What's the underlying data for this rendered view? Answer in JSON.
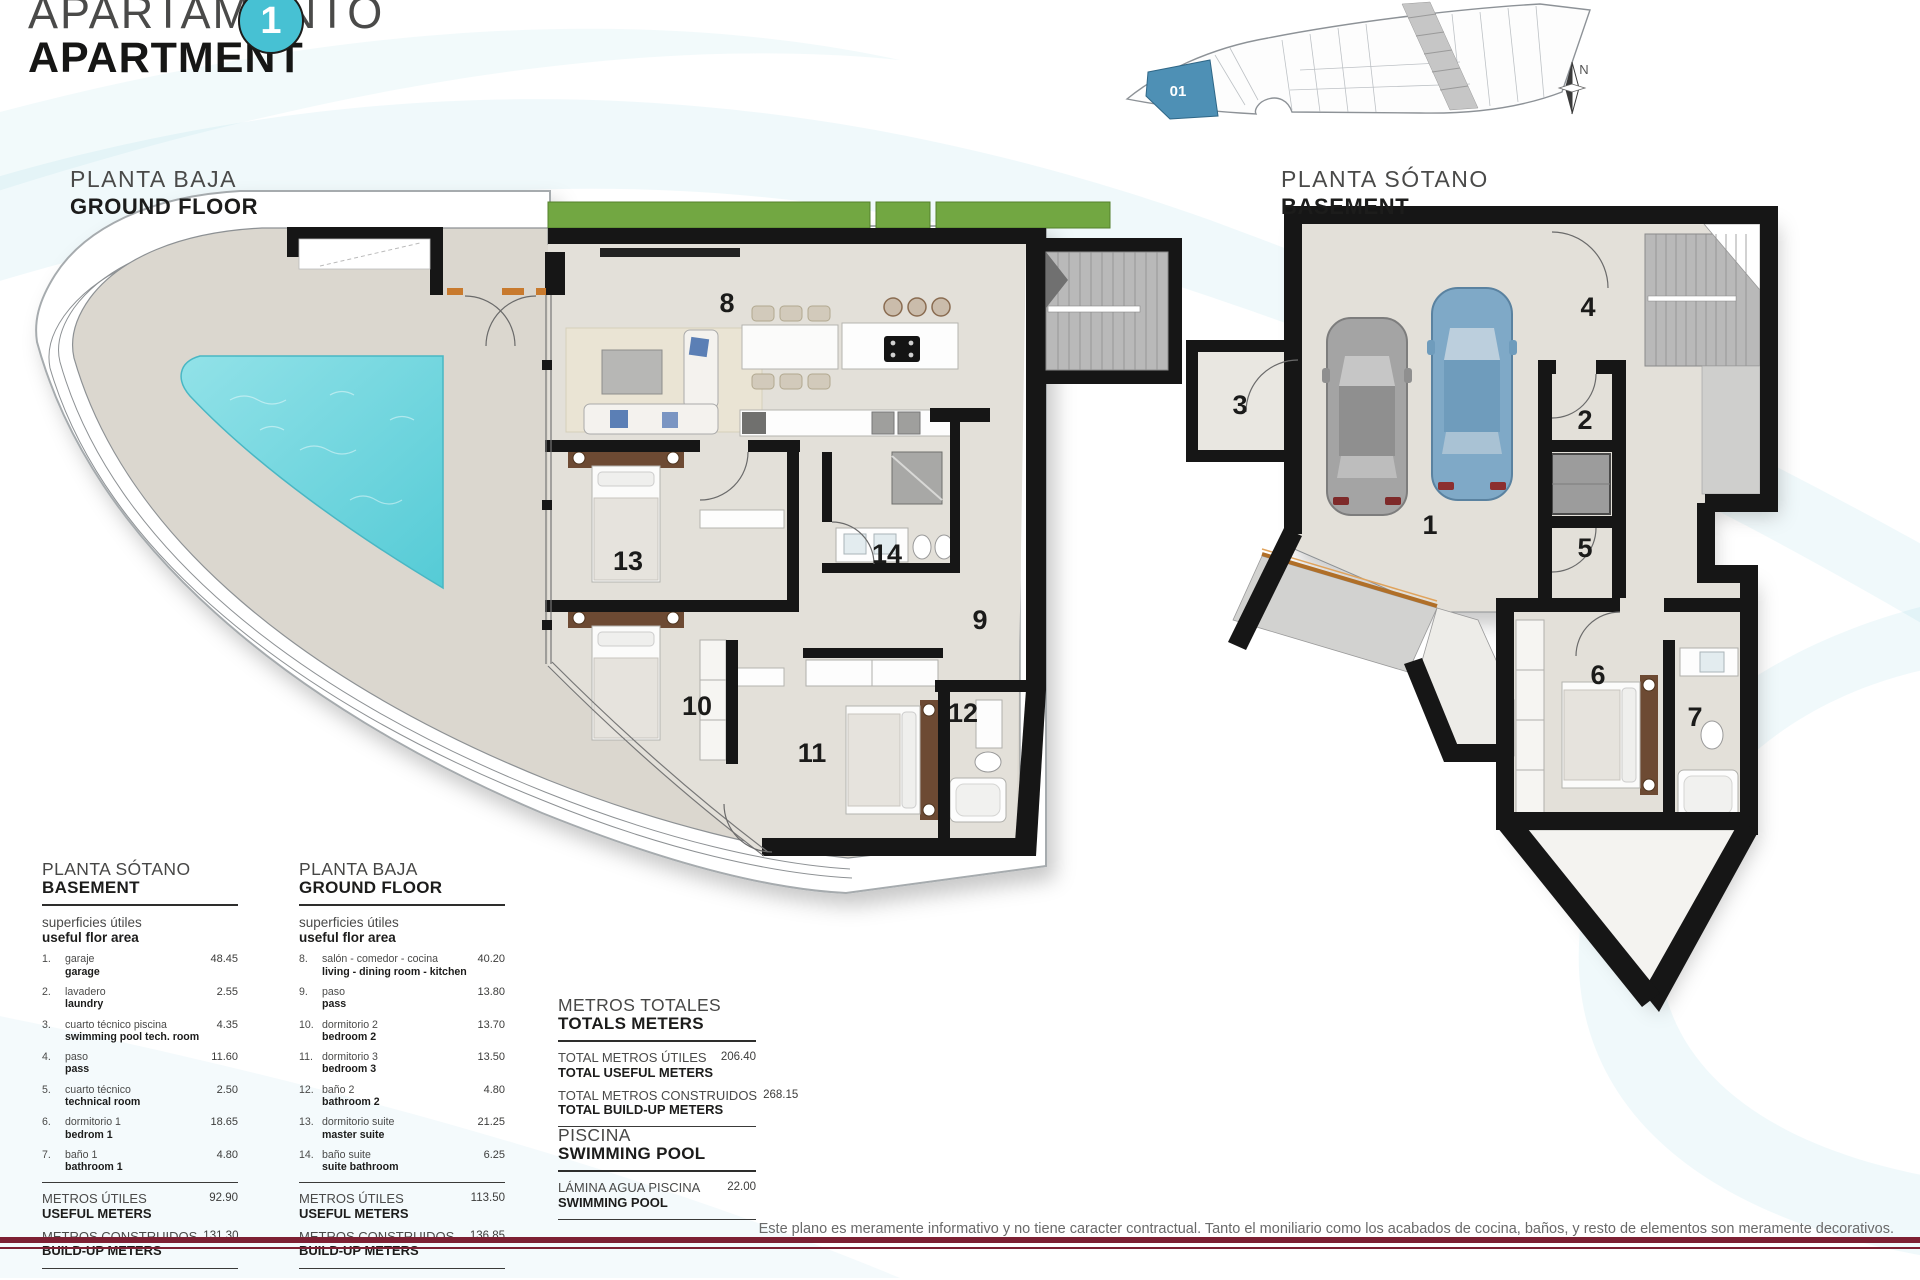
{
  "header": {
    "title_es": "APARTAMENTO",
    "title_en": "APARTMENT",
    "unit_number": "1"
  },
  "site_plan": {
    "unit_label": "01",
    "compass_label": "N"
  },
  "plans": {
    "ground_floor": {
      "label_es": "PLANTA BAJA",
      "label_en": "GROUND FLOOR",
      "rooms": [
        "8",
        "13",
        "14",
        "9",
        "10",
        "11",
        "12"
      ]
    },
    "basement": {
      "label_es": "PLANTA SÓTANO",
      "label_en": "BASEMENT",
      "rooms": [
        "1",
        "2",
        "3",
        "4",
        "5",
        "6",
        "7"
      ]
    }
  },
  "tables": {
    "basement": {
      "title_es": "PLANTA SÓTANO",
      "title_en": "BASEMENT",
      "subtitle_es": "superficies útiles",
      "subtitle_en": "useful flor area",
      "rows": [
        {
          "num": "1.",
          "es": "garaje",
          "en": "garage",
          "value": "48.45"
        },
        {
          "num": "2.",
          "es": "lavadero",
          "en": "laundry",
          "value": "2.55"
        },
        {
          "num": "3.",
          "es": "cuarto técnico piscina",
          "en": "swimming pool tech. room",
          "value": "4.35"
        },
        {
          "num": "4.",
          "es": "paso",
          "en": "pass",
          "value": "11.60"
        },
        {
          "num": "5.",
          "es": "cuarto técnico",
          "en": "technical room",
          "value": "2.50"
        },
        {
          "num": "6.",
          "es": "dormitorio 1",
          "en": "bedrom 1",
          "value": "18.65"
        },
        {
          "num": "7.",
          "es": "baño 1",
          "en": "bathroom 1",
          "value": "4.80"
        }
      ],
      "totals": [
        {
          "es": "METROS ÚTILES",
          "en": "USEFUL METERS",
          "value": "92.90"
        },
        {
          "es": "METROS CONSTRUIDOS",
          "en": "BUILD-UP METERS",
          "value": "131.30"
        }
      ]
    },
    "ground_floor": {
      "title_es": "PLANTA BAJA",
      "title_en": "GROUND FLOOR",
      "subtitle_es": "superficies útiles",
      "subtitle_en": "useful flor area",
      "rows": [
        {
          "num": "8.",
          "es": "salón - comedor - cocina",
          "en": "living - dining room - kitchen",
          "value": "40.20"
        },
        {
          "num": "9.",
          "es": "paso",
          "en": "pass",
          "value": "13.80"
        },
        {
          "num": "10.",
          "es": "dormitorio 2",
          "en": "bedroom 2",
          "value": "13.70"
        },
        {
          "num": "11.",
          "es": "dormitorio 3",
          "en": "bedroom 3",
          "value": "13.50"
        },
        {
          "num": "12.",
          "es": "baño 2",
          "en": "bathroom 2",
          "value": "4.80"
        },
        {
          "num": "13.",
          "es": "dormitorio suite",
          "en": "master suite",
          "value": "21.25"
        },
        {
          "num": "14.",
          "es": "baño suite",
          "en": "suite bathroom",
          "value": "6.25"
        }
      ],
      "totals": [
        {
          "es": "METROS ÚTILES",
          "en": "USEFUL METERS",
          "value": "113.50"
        },
        {
          "es": "METROS CONSTRUIDOS",
          "en": "BUILD-UP METERS",
          "value": "136.85"
        }
      ]
    },
    "totals_meters": {
      "title_es": "METROS TOTALES",
      "title_en": "TOTALS METERS",
      "rows": [
        {
          "es": "TOTAL METROS ÚTILES",
          "en": "TOTAL USEFUL METERS",
          "value": "206.40"
        },
        {
          "es": "TOTAL METROS CONSTRUIDOS",
          "en": "TOTAL BUILD-UP METERS",
          "value": "268.15"
        }
      ]
    },
    "pool": {
      "title_es": "PISCINA",
      "title_en": "SWIMMING POOL",
      "rows": [
        {
          "es": "LÁMINA AGUA PISCINA",
          "en": "SWIMMING POOL",
          "value": "22.00"
        }
      ]
    }
  },
  "footer": {
    "disclaimer": "Este plano es meramente informativo y no tiene caracter contractual. Tanto el moniliario como los acabados de cocina, baños, y resto de elementos son meramente decorativos."
  },
  "colors": {
    "accent_teal": "#47c1d3",
    "pool_water": "#76d7de",
    "rule_maroon": "#7d2033",
    "wall": "#161616",
    "terrace_floor": "#dbd7cf",
    "interior_floor": "#e3e0d9",
    "grass": "#72a742",
    "car_gray": "#9c9c9c",
    "car_blue": "#7fa9c7",
    "site_unit_blue": "#4e90b5"
  }
}
